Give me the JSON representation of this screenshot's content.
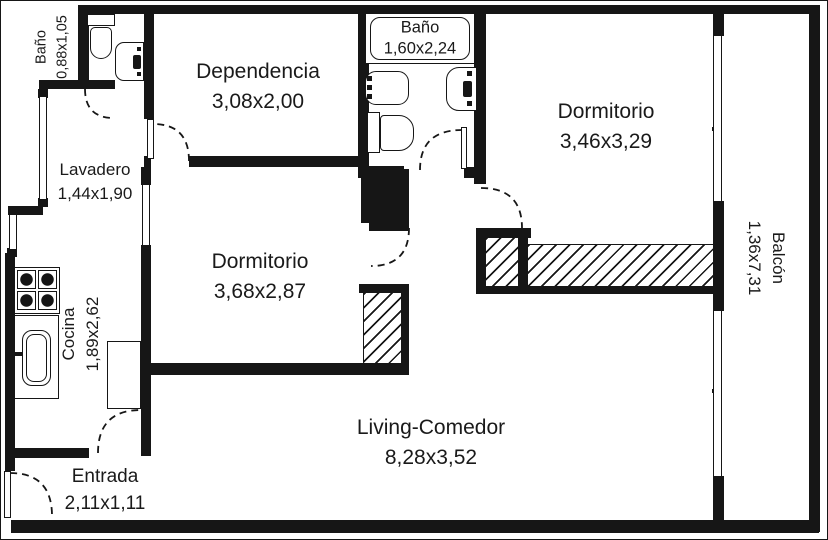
{
  "plan": {
    "type": "apartment-floor-plan",
    "rooms": [
      {
        "id": "bano_small",
        "name": "Baño",
        "dims": "0,88x1,05"
      },
      {
        "id": "dependencia",
        "name": "Dependencia",
        "dims": "3,08x2,00"
      },
      {
        "id": "bano_main",
        "name": "Baño",
        "dims": "1,60x2,24"
      },
      {
        "id": "dormitorio_1",
        "name": "Dormitorio",
        "dims": "3,46x3,29"
      },
      {
        "id": "lavadero",
        "name": "Lavadero",
        "dims": "1,44x1,90"
      },
      {
        "id": "dormitorio_2",
        "name": "Dormitorio",
        "dims": "3,68x2,87"
      },
      {
        "id": "balcon",
        "name": "Balcón",
        "dims": "1,36x7,31"
      },
      {
        "id": "cocina",
        "name": "Cocina",
        "dims": "1,89x2,62"
      },
      {
        "id": "living",
        "name": "Living-Comedor",
        "dims": "8,28x3,52"
      },
      {
        "id": "entrada",
        "name": "Entrada",
        "dims": "2,11x1,11"
      }
    ],
    "colors": {
      "wall": "#161616",
      "background": "#ffffff",
      "text": "#1a1a1a"
    }
  }
}
